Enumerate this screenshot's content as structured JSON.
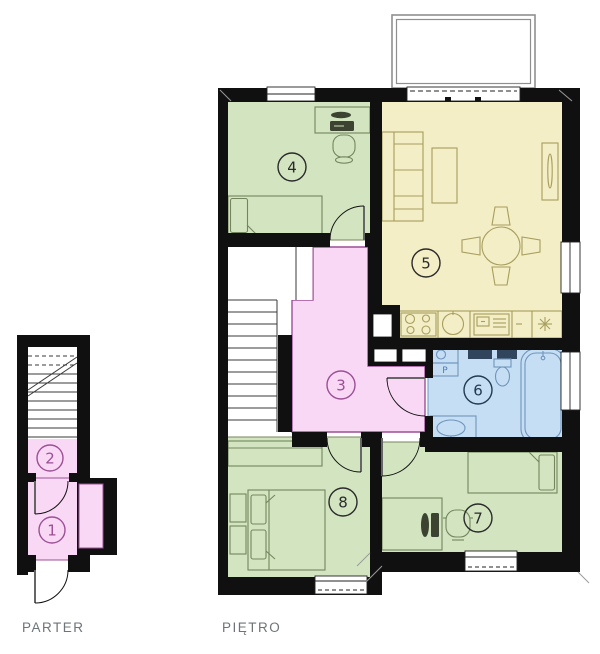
{
  "colors": {
    "wall": "#101010",
    "room_green": "#d3e5c0",
    "room_yellow": "#f3eec6",
    "room_pink": "#f8d8f4",
    "room_blue": "#c5def4",
    "outline_green": "#74855e",
    "outline_yellow": "#a79d5e",
    "outline_blue": "#6f94bb",
    "outline_dark_blue": "#31455c",
    "outline_pink": "#9c4f96",
    "number_dark": "#2a2a2a",
    "number_bath": "#223a52",
    "label_text": "#6d7478"
  },
  "parter": {
    "label": "PARTER",
    "rooms": [
      {
        "number": "1",
        "color": "#f8d8f4"
      },
      {
        "number": "2",
        "color": "#f8d8f4"
      }
    ]
  },
  "pietro": {
    "label": "PIĘTRO",
    "washer_label": "P",
    "rooms": [
      {
        "number": "3",
        "color": "#f8d8f4"
      },
      {
        "number": "4",
        "color": "#d3e5c0"
      },
      {
        "number": "5",
        "color": "#f3eec6"
      },
      {
        "number": "6",
        "color": "#c5def4"
      },
      {
        "number": "7",
        "color": "#d3e5c0"
      },
      {
        "number": "8",
        "color": "#d3e5c0"
      }
    ]
  }
}
